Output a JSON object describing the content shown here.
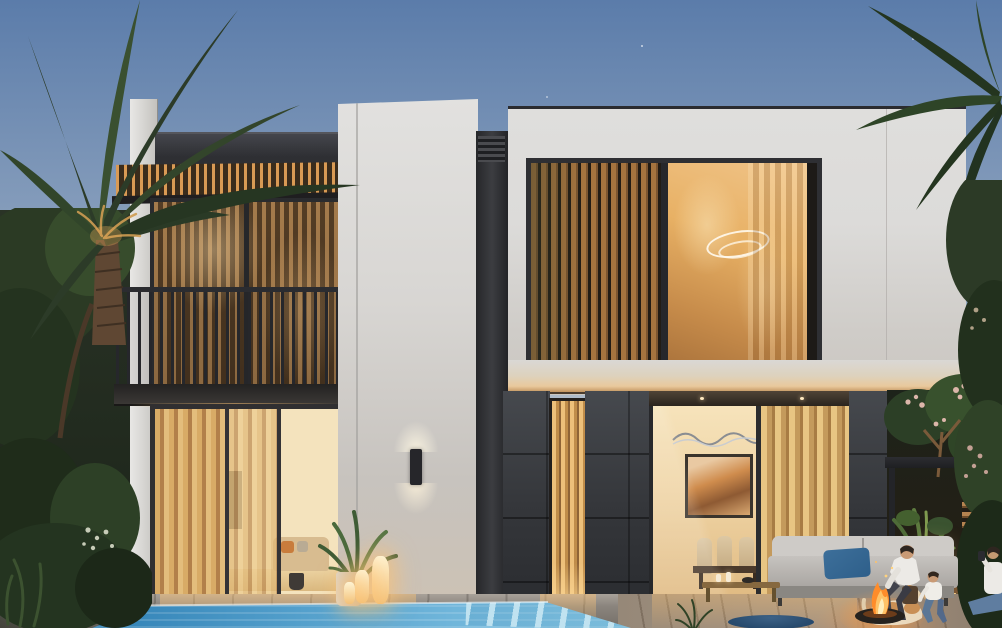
{
  "scene": {
    "type": "architectural-render",
    "setting": "Modern two-storey villa exterior at dusk with swimming pool, palm trees and lit interiors",
    "time_of_day": "dusk",
    "objects": [
      "dusk-sky",
      "palm-tree-left",
      "palm-tree-right",
      "garden-shrubs",
      "low-garden-wall",
      "left-building-balcony",
      "wood-slat-canopy",
      "balcony-railing",
      "bronze-glass-window",
      "ground-floor-living-room",
      "center-white-tower",
      "wall-sconce",
      "potted-plant",
      "candle-lanterns",
      "right-building-facade",
      "wood-louver-window",
      "ring-chandelier",
      "stone-clad-wall",
      "narrow-lit-window",
      "dining-room-glass-wall",
      "abstract-artwork",
      "wavy-wall-art",
      "sheer-curtains",
      "patio-pergola",
      "plumeria-tree",
      "slat-screen",
      "outdoor-sofa",
      "blue-pillow",
      "coffee-table",
      "blue-pouf",
      "fire-pit",
      "dog",
      "man-sitting",
      "child-crouching",
      "person-right-edge",
      "wooden-bench",
      "glowing-lamps",
      "swimming-pool",
      "pool-steps",
      "timber-deck"
    ]
  },
  "colors": {
    "sky_top": "#5b7caa",
    "sky_mid": "#93a8c1",
    "sky_horizon": "#c9d0d6",
    "facade_white": "#dcdbd9",
    "facade_shade": "#c7c3be",
    "fascia_dark": "#2e2f33",
    "charcoal": "#35373b",
    "wood_lit": "#d99a54",
    "wood_dark": "#3a2c1c",
    "louver_wood": "#a5743f",
    "glass_bronze": "#7a5a38",
    "glass_glow": "#e8b165",
    "interior_bright": "#f4e3bd",
    "curtain_gold": "#d8ab66",
    "railing": "#26272b",
    "pool_deep": "#2e7fb4",
    "pool_light": "#8ccbe6",
    "pool_step": "#c3e4f1",
    "deck": "#8b857e",
    "foliage_dark": "#263622",
    "foliage_mid": "#3a5030",
    "foliage_lit": "#7f9a4f",
    "flower_pink": "#d9b2a6",
    "fire_orange": "#ff8c2a",
    "fire_glow": "#ffc266",
    "lantern_glow": "#ffd9a0",
    "sofa_gray": "#c6c3bf",
    "pillow_blue": "#2e5f8a",
    "pouf_blue": "#274a6d",
    "skin": "#c99a75",
    "shirt_white": "#eceae6",
    "jeans": "#5b7796"
  }
}
